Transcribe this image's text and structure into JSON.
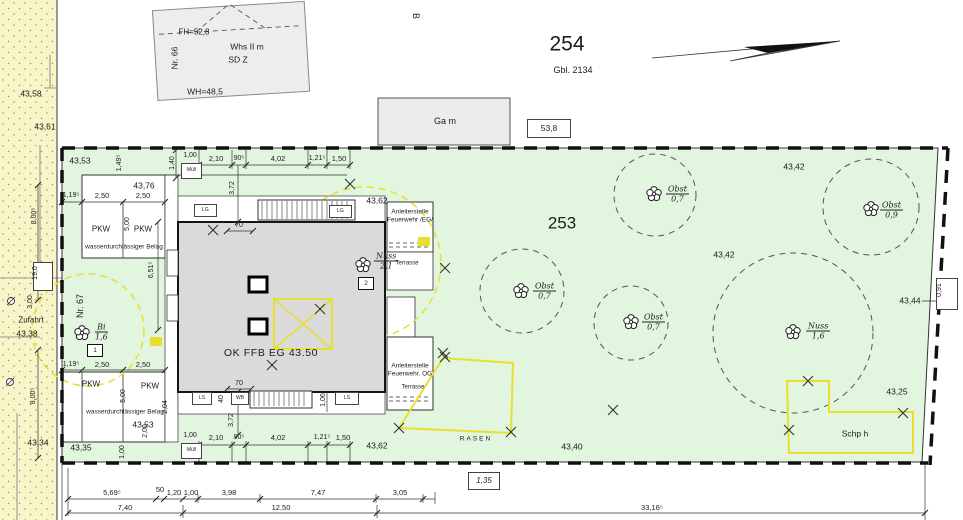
{
  "colors": {
    "street": "#f8f5c9",
    "plot": "#e2f5df",
    "building_main": "#dadada",
    "building_light": "#ededed",
    "annotation_yellow": "#e8df30"
  },
  "top": {
    "b": "B",
    "parcel_254": "254",
    "gbl": "Gbl. 2134",
    "garage": "Ga m",
    "dim_53_8": "53,8",
    "house66": {
      "fh": "FH=52,8",
      "nr": "Nr. 66",
      "name1": "Whs II m",
      "name2": "SD Z",
      "wh": "WH=48,5"
    }
  },
  "street": {
    "e_4358": "43,58",
    "e_4361": "43,61",
    "e_4338": "43,38",
    "e_4334": "43,34",
    "zufahrt": "Zufahrt",
    "d_800": "8,00⁵",
    "d_190": "19,0",
    "d_300": "3,00"
  },
  "plot": {
    "parcel_253": "253",
    "corner_tl": "43,53",
    "corner_bl": "43,35",
    "e_4362_top": "43,62",
    "e_4362_bottom": "43,62",
    "e_4342_top": "43,42",
    "e_4342_mid": "43,42",
    "e_4344": "43,44",
    "e_4325": "43,25",
    "e_4340": "43,40",
    "d_091": "0,91",
    "rasen": "RASEN",
    "schuppen": "Schp h",
    "nr67": "Nr. 67"
  },
  "trees": {
    "t1": {
      "name": "Obst",
      "size": "0,7"
    },
    "t2": {
      "name": "Obst",
      "size": "0,9"
    },
    "t3": {
      "name": "Obst",
      "size": "0,7"
    },
    "t4": {
      "name": "Obst",
      "size": "0,7"
    },
    "t5": {
      "name": "Nuss",
      "size": "1,6"
    },
    "t6": {
      "name": "Nuss",
      "size": "2,1",
      "tag": "2"
    },
    "t7": {
      "name": "Bi",
      "size": "1,6",
      "tag": "1"
    }
  },
  "parking": {
    "pkw": "PKW",
    "belag": "wasserdurchlässiger Belag",
    "e_top": "43,76",
    "e_bottom": "43,53",
    "d_119": "1,19⁵",
    "d_250": "2,50",
    "d_500": "5,00",
    "d_149": "1,49⁵",
    "d_651": "6,51⁵",
    "d_204": "2,04",
    "d_200": "2,00",
    "d_100": "1,00"
  },
  "building": {
    "ok_ffb": "OK FFB EG 43.50",
    "muell": "Müll",
    "lg": "LG",
    "ls": "LS",
    "wb": "WB",
    "d_100": "1,00",
    "d_210": "2,10",
    "d_90": "90⁵",
    "d_402": "4,02",
    "d_121": "1,21⁵",
    "d_150": "1,50",
    "d_140": "1,40",
    "d_372": "3,72",
    "d_70": "70",
    "d_40": "40",
    "d_106": "1,06",
    "fire_eg1": "Anleiterstelle",
    "fire_eg2": "Feuerwehr /EG/",
    "fire_og1": "Anleiterstelle",
    "fire_og2": "Feuerwehr. OG",
    "terrasse": "Terrasse"
  },
  "bottom_dims": {
    "r1": [
      "5,69⁵",
      "50",
      "1,20",
      "1,00",
      "3,98",
      "7,47",
      "3,05"
    ],
    "d_740": "7,40",
    "d_1250": "12,50",
    "d_3316": "33,16⁵",
    "boxed": "1,35"
  }
}
